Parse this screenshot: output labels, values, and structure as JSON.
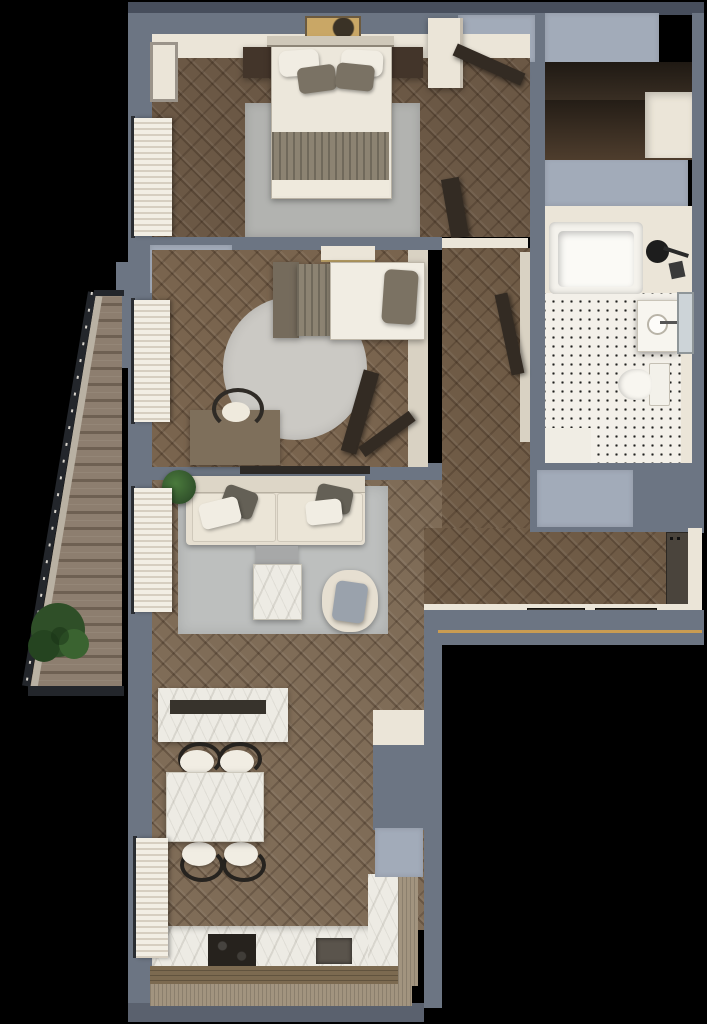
{
  "scene": {
    "title": "apartment-floor-plan-top-view-render",
    "canvas": {
      "width": 707,
      "height": 1024
    },
    "background": "#000000",
    "style": "photorealistic 3d top-down render, herringbone parquet, blue-gray walls"
  },
  "palette": {
    "bg": "#000000",
    "wall": "#6c7583",
    "wallDark": "#474e5c",
    "wallSouth": "#5a616e",
    "cap": "#a2abb9",
    "plaster": "#ebe5d8",
    "plasterDim": "#d9d2c3",
    "floorBed": "#6b5845",
    "floorKid": "#79644e",
    "floorHall": "#6f5b46",
    "floorLiving": "#7f6c57",
    "deck": "#8d7e6f",
    "deckLine": "#6e6052",
    "tileBg": "#f3f0e9",
    "tileDot": "#20201e",
    "rug": "#bdbfbe",
    "rugBed": "#b2b3b0",
    "rugRound": "#cbc9c4",
    "sofa": "#e6dfd1",
    "sofaSeat": "#ebe5d7",
    "pillowDark": "#646056",
    "pillowLight": "#f1ede3",
    "duvet": "#ece7db",
    "blanket": "#8c8372",
    "headboard": "#756b5c",
    "woodDark": "#43352a",
    "doorDark": "#332b23",
    "doorEntry": "#4a443c",
    "marble": "#edebe4",
    "counterWoodTop": "#7c6a50",
    "woodLight": "#a2947f",
    "gold": "#c99c52",
    "plant": "#35582e",
    "plantDark": "#22401f",
    "mirror": "#cdd4d8",
    "cushion": "#9aa2ac",
    "tray": "#37332c",
    "cooktop": "#26221d",
    "sinkDark": "#5a544c",
    "tubInner": "#fbfaf6",
    "fixture": "#1d1d1d"
  },
  "rooms": [
    {
      "id": "master-bedroom",
      "furniture": [
        "double-bed",
        "white-pillows",
        "taupe-pillows",
        "taupe-blanket",
        "nightstand-left",
        "nightstand-right",
        "area-rug",
        "wall-art",
        "picture-frame",
        "closet",
        "open-door",
        "window-curtains"
      ]
    },
    {
      "id": "wardrobe-room",
      "furniture": [
        "built-in-closet"
      ]
    },
    {
      "id": "bathroom",
      "furniture": [
        "bathtub",
        "shower-head",
        "vanity-sink",
        "mirror",
        "toilet",
        "bath-mat",
        "dotted-tile-floor"
      ]
    },
    {
      "id": "kids-bedroom",
      "furniture": [
        "single-bed",
        "pillow",
        "round-rug",
        "desk",
        "desk-chair",
        "wall-shelf",
        "window-curtains",
        "open-doors"
      ]
    },
    {
      "id": "hallway",
      "furniture": [
        "open-bathroom-door"
      ]
    },
    {
      "id": "living-room",
      "furniture": [
        "sofa",
        "throw-pillows",
        "area-rug",
        "coffee-table",
        "side-table",
        "armchair",
        "potted-plant",
        "media-console",
        "window-curtains"
      ]
    },
    {
      "id": "kitchen-dining",
      "furniture": [
        "dining-table",
        "dining-chairs-x4",
        "counter",
        "cooktop",
        "sink",
        "tall-cabinet",
        "window-curtains",
        "wood-sill"
      ]
    },
    {
      "id": "entry",
      "furniture": [
        "entrance-door",
        "doormat-left",
        "doormat-right",
        "threshold"
      ]
    },
    {
      "id": "balcony",
      "furniture": [
        "wood-deck",
        "railing",
        "potted-plant"
      ]
    }
  ]
}
